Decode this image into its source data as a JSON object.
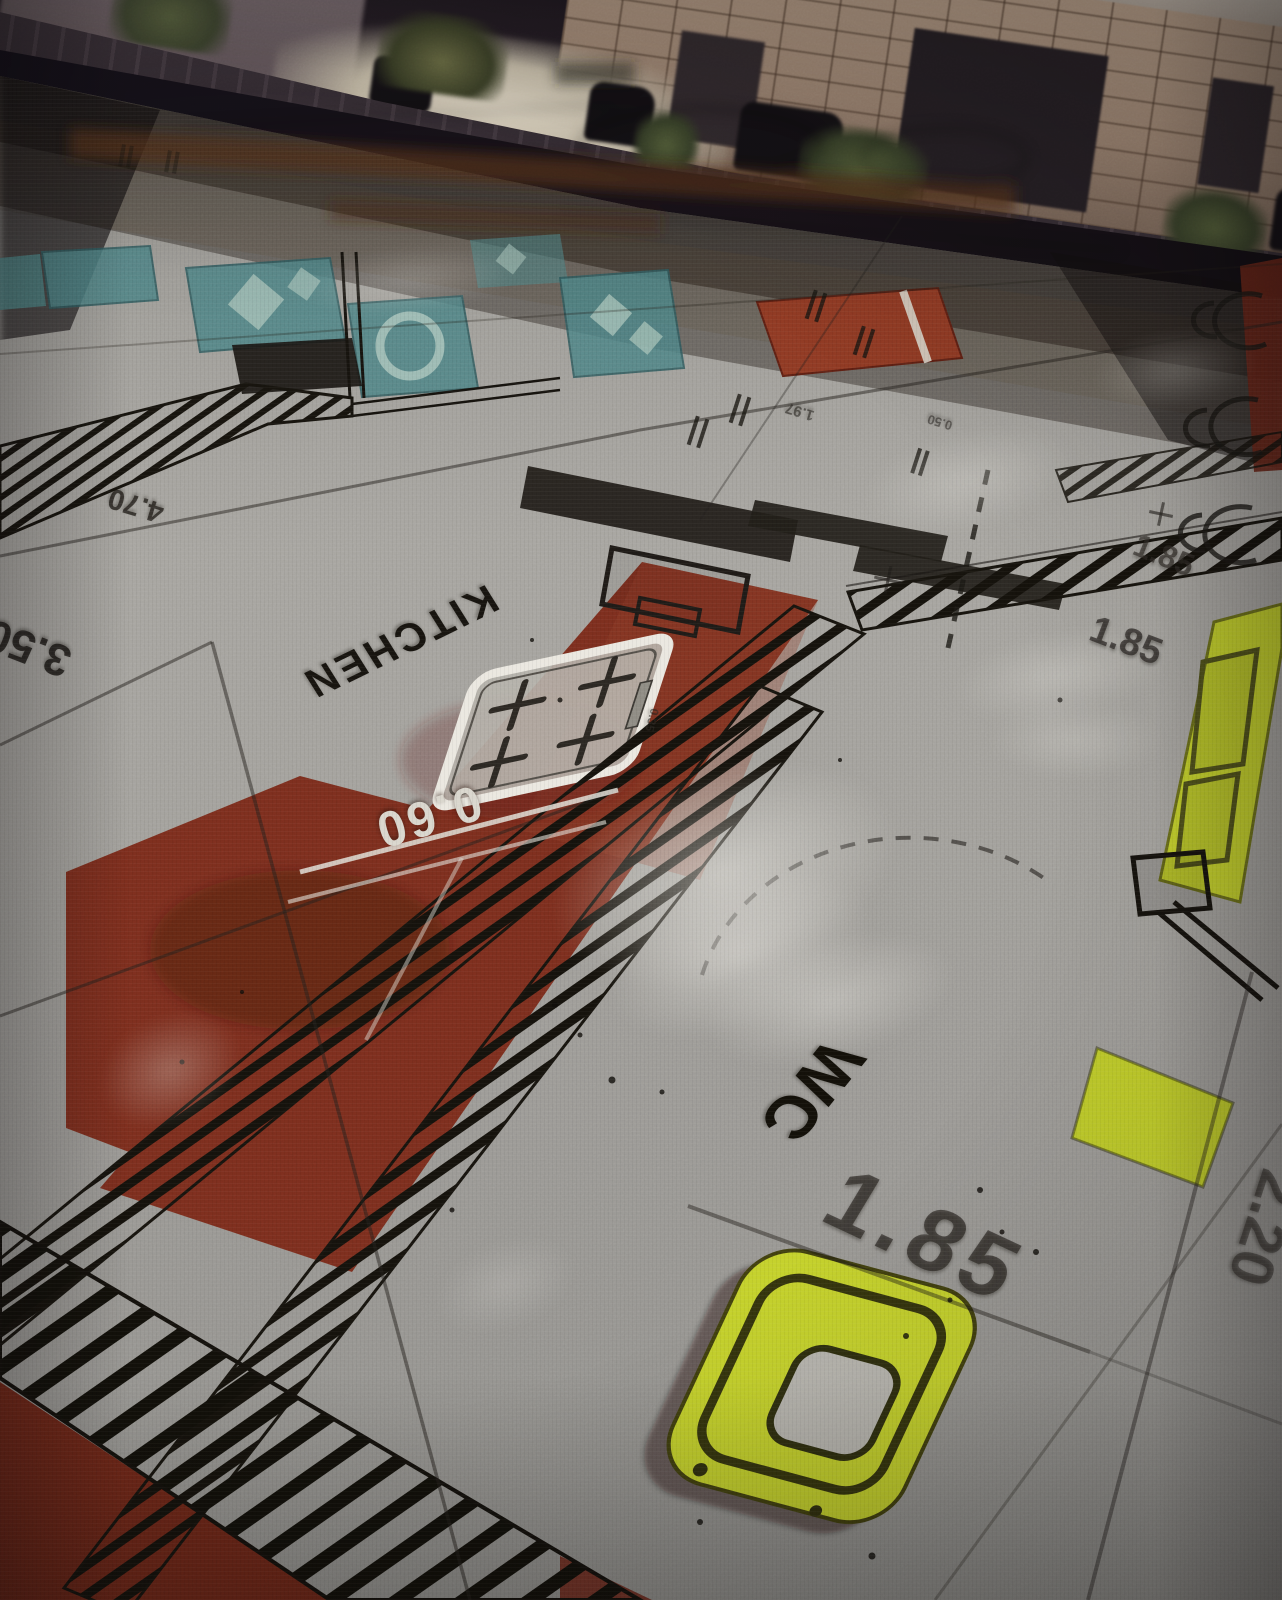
{
  "wall_screen": {
    "scene": "night street projection",
    "elements": [
      "stone-block-wall",
      "dark-gates",
      "parked-cars",
      "shrubs",
      "wet-pavement"
    ],
    "colors": {
      "stone": "#ab9480",
      "pavement": "#3a3138",
      "shadow": "#16121a"
    }
  },
  "floor_plan": {
    "room_labels": [
      {
        "id": "kitchen",
        "text": "KITCHEN"
      },
      {
        "id": "wc",
        "text": "WC"
      }
    ],
    "dimensions": [
      {
        "id": "dim-060",
        "text": "0.60"
      },
      {
        "id": "dim-470",
        "text": "4.70"
      },
      {
        "id": "dim-350",
        "text": "3.50"
      },
      {
        "id": "dim-185-upper",
        "text": "1.85"
      },
      {
        "id": "dim-185-lower",
        "text": "1.85"
      },
      {
        "id": "dim-185-large",
        "text": "1.85"
      },
      {
        "id": "dim-220",
        "text": "2.20"
      },
      {
        "id": "dim-197",
        "text": "1.97"
      },
      {
        "id": "dim-050",
        "text": "0.50"
      },
      {
        "id": "dim-035",
        "text": "0.35"
      }
    ],
    "fixtures": [
      "stove",
      "toilet",
      "sink-counter",
      "teal-furniture"
    ],
    "colors": {
      "zone_red": "#7c2e1e",
      "zone_red_bright": "#8f3a24",
      "zone_teal": "#4e8486",
      "zone_yellow": "#c3d02c",
      "plan_line": "#17140e",
      "floor_grey": "#a09e99",
      "white_dim_text": "#d9d6cd"
    }
  }
}
